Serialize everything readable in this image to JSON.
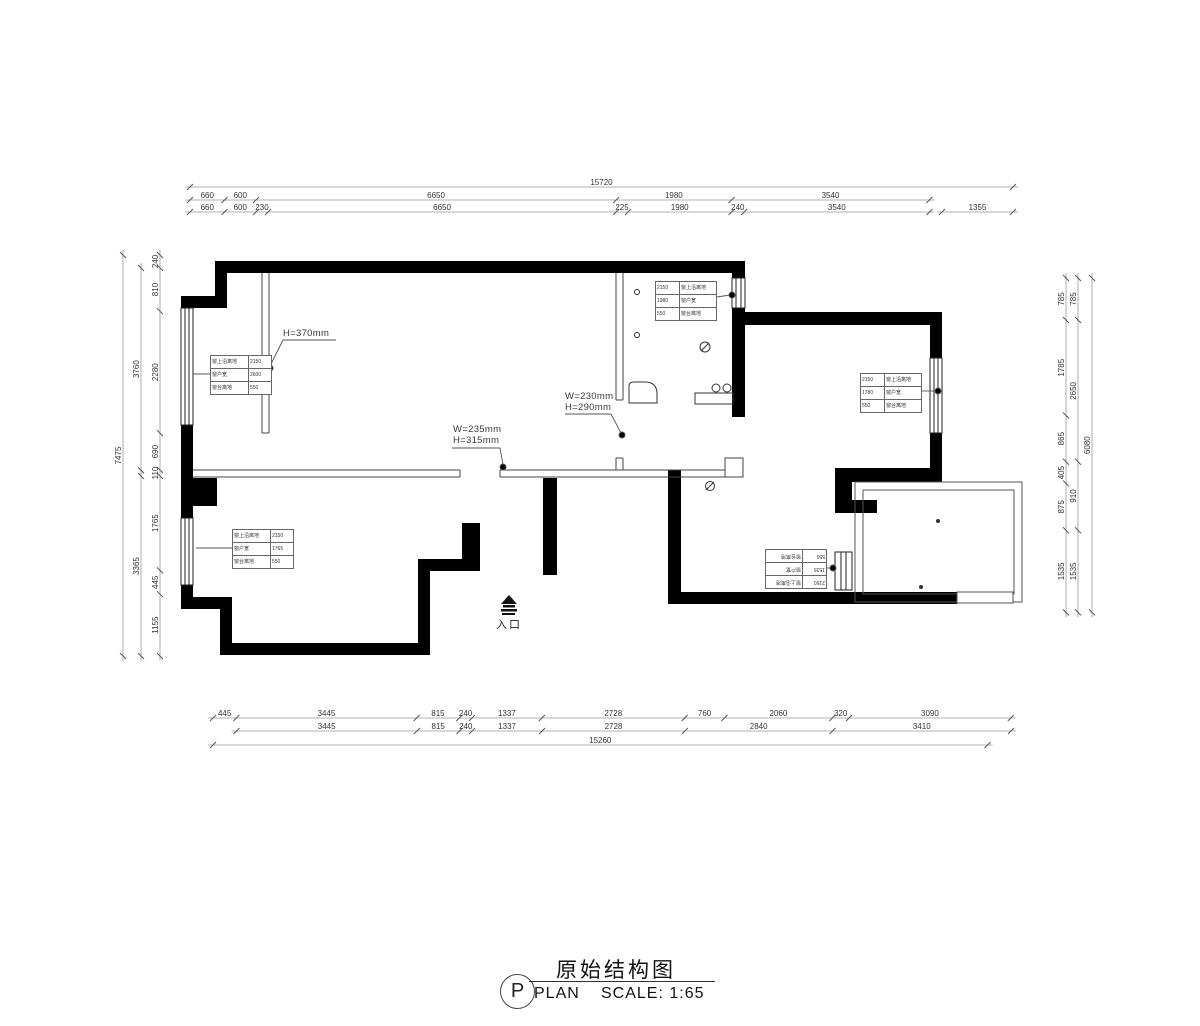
{
  "title_block": {
    "symbol_letter": "P",
    "title": "原始结构图",
    "plan_label": "PLAN",
    "scale_label": "SCALE: 1:65"
  },
  "entrance_label": "入口",
  "annotations": {
    "beam_height": "H=370mm",
    "opening1_w": "W=235mm",
    "opening1_h": "H=315mm",
    "opening2_w": "W=230mm",
    "opening2_h": "H=290mm"
  },
  "window_tables": {
    "left_upper": {
      "rows": [
        [
          "窗上沿离地",
          "2150"
        ],
        [
          "窗户宽",
          "2600"
        ],
        [
          "窗台离地",
          "550"
        ]
      ]
    },
    "top_middle": {
      "rows": [
        [
          "2150",
          "窗上沿离地"
        ],
        [
          "1980",
          "窗户宽"
        ],
        [
          "550",
          "窗台离地"
        ]
      ]
    },
    "right_room": {
      "rows": [
        [
          "2150",
          "窗上沿离地"
        ],
        [
          "1780",
          "窗户宽"
        ],
        [
          "550",
          "窗台离地"
        ]
      ]
    },
    "left_lower": {
      "rows": [
        [
          "窗上沿离地",
          "2150"
        ],
        [
          "窗户宽",
          "1765"
        ],
        [
          "窗台离地",
          "550"
        ]
      ]
    },
    "bottom_right": {
      "rows": [
        [
          "2150",
          "窗上沿离地"
        ],
        [
          "1535",
          "窗户宽"
        ],
        [
          "550",
          "窗台离地"
        ]
      ]
    }
  },
  "dimensions": {
    "top_total": [
      "15720"
    ],
    "top_major": [
      "660",
      "600",
      "6650",
      "1980",
      "3540"
    ],
    "top_minor": [
      "660",
      "600",
      "230",
      "6650",
      "225",
      "1980",
      "240",
      "3540"
    ],
    "top_right": [
      "1355"
    ],
    "bottom_major": [
      "445",
      "3445",
      "815",
      "240",
      "1337",
      "2728",
      "760",
      "2060",
      "320",
      "3090"
    ],
    "bottom_minor": [
      "3445",
      "815",
      "240",
      "1337",
      "2728",
      "2840",
      "3410"
    ],
    "bottom_total": [
      "15260"
    ],
    "left_total": [
      "7475"
    ],
    "left_mid_upper": [
      "3760"
    ],
    "left_mid_lower": [
      "3365"
    ],
    "left_inner": [
      "240",
      "810",
      "2280",
      "690",
      "110",
      "1765",
      "445",
      "1155"
    ],
    "right_total": [
      "6080"
    ],
    "right_mid": [
      "785",
      "2650",
      "910",
      "1535"
    ],
    "right_inner": [
      "785",
      "1785",
      "865",
      "405",
      "875",
      "1535"
    ]
  }
}
